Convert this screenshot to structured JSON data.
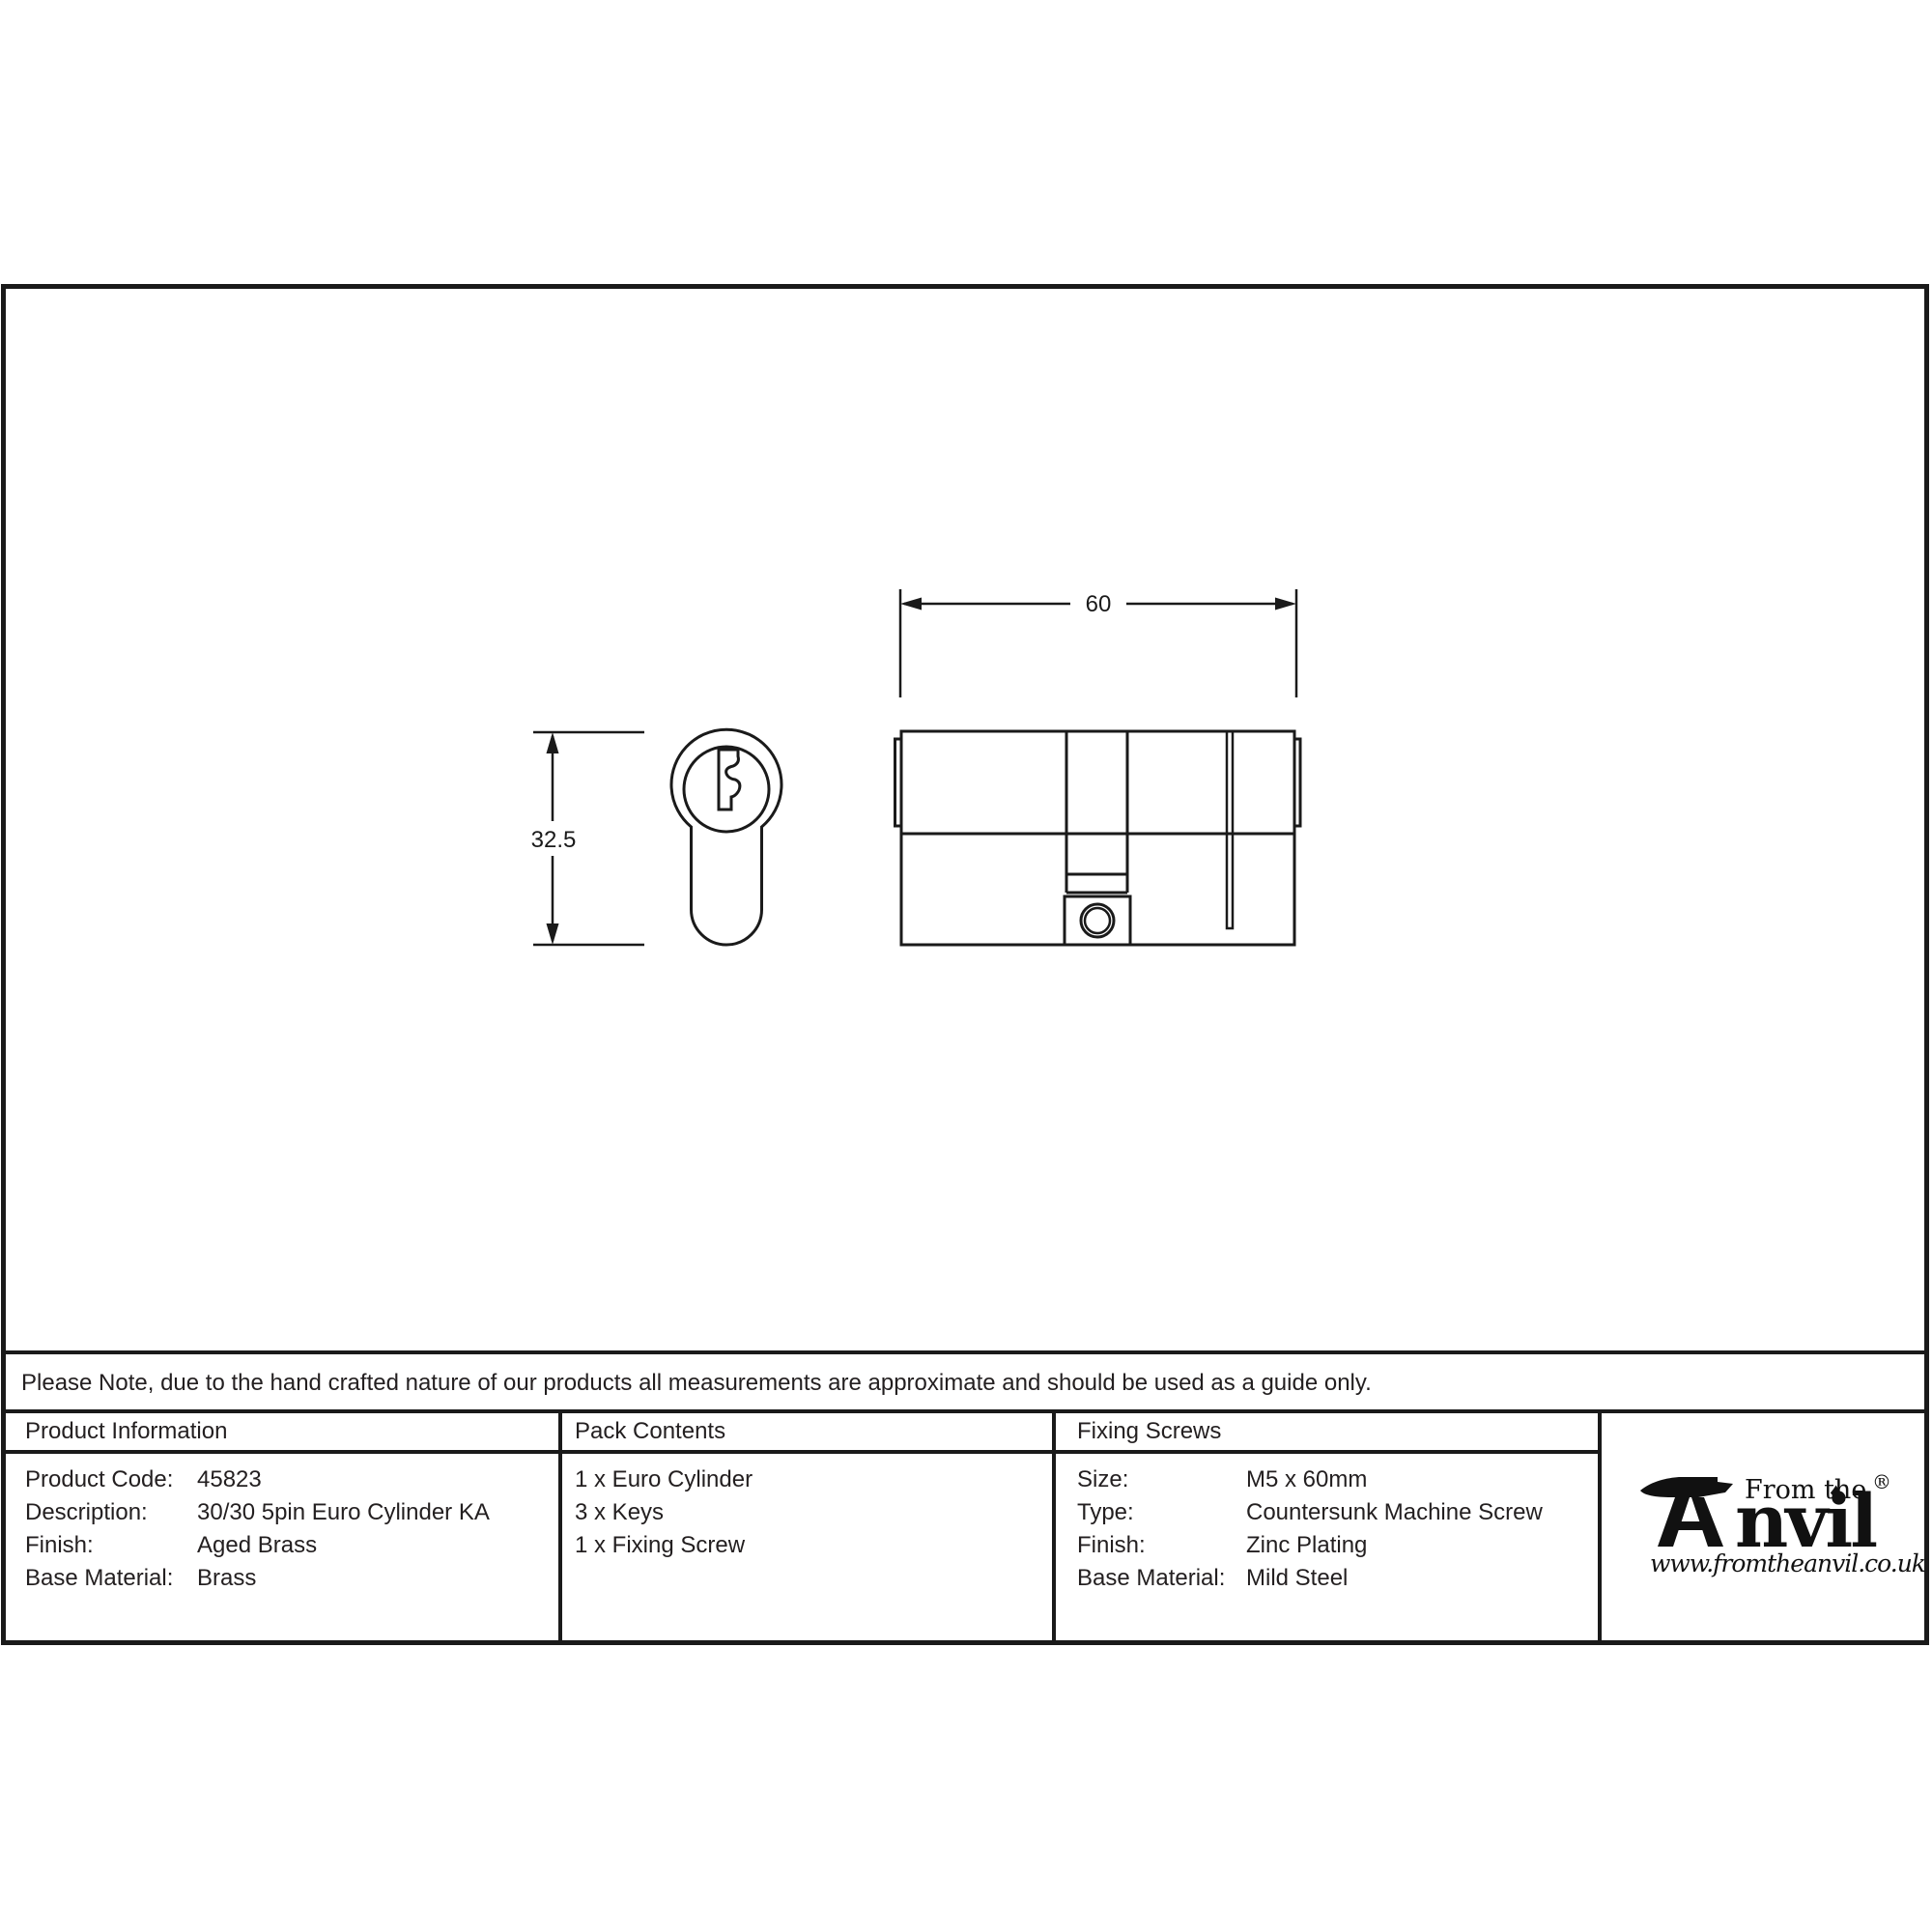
{
  "drawing": {
    "width_dim": "60",
    "height_dim": "32.5"
  },
  "note": "Please Note, due to the hand crafted nature of our products all measurements are approximate and should be used as a guide only.",
  "product_information": {
    "header": "Product Information",
    "rows": [
      {
        "label": "Product Code:",
        "value": "45823"
      },
      {
        "label": "Description:",
        "value": "30/30 5pin Euro Cylinder KA"
      },
      {
        "label": "Finish:",
        "value": "Aged Brass"
      },
      {
        "label": "Base Material:",
        "value": "Brass"
      }
    ]
  },
  "pack_contents": {
    "header": "Pack Contents",
    "items": [
      "1 x Euro Cylinder",
      "3 x Keys",
      "1 x Fixing Screw"
    ]
  },
  "fixing_screws": {
    "header": "Fixing Screws",
    "rows": [
      {
        "label": "Size:",
        "value": "M5 x 60mm"
      },
      {
        "label": "Type:",
        "value": "Countersunk Machine Screw"
      },
      {
        "label": "Finish:",
        "value": "Zinc Plating"
      },
      {
        "label": "Base Material:",
        "value": "Mild Steel"
      }
    ]
  },
  "logo": {
    "from_the": "From the",
    "anvil_word": "nvil",
    "registered": "®",
    "diamond": "♦",
    "website": "www.fromtheanvil.co.uk"
  },
  "colors": {
    "line": "#1a1a1a",
    "text": "#231f20"
  }
}
